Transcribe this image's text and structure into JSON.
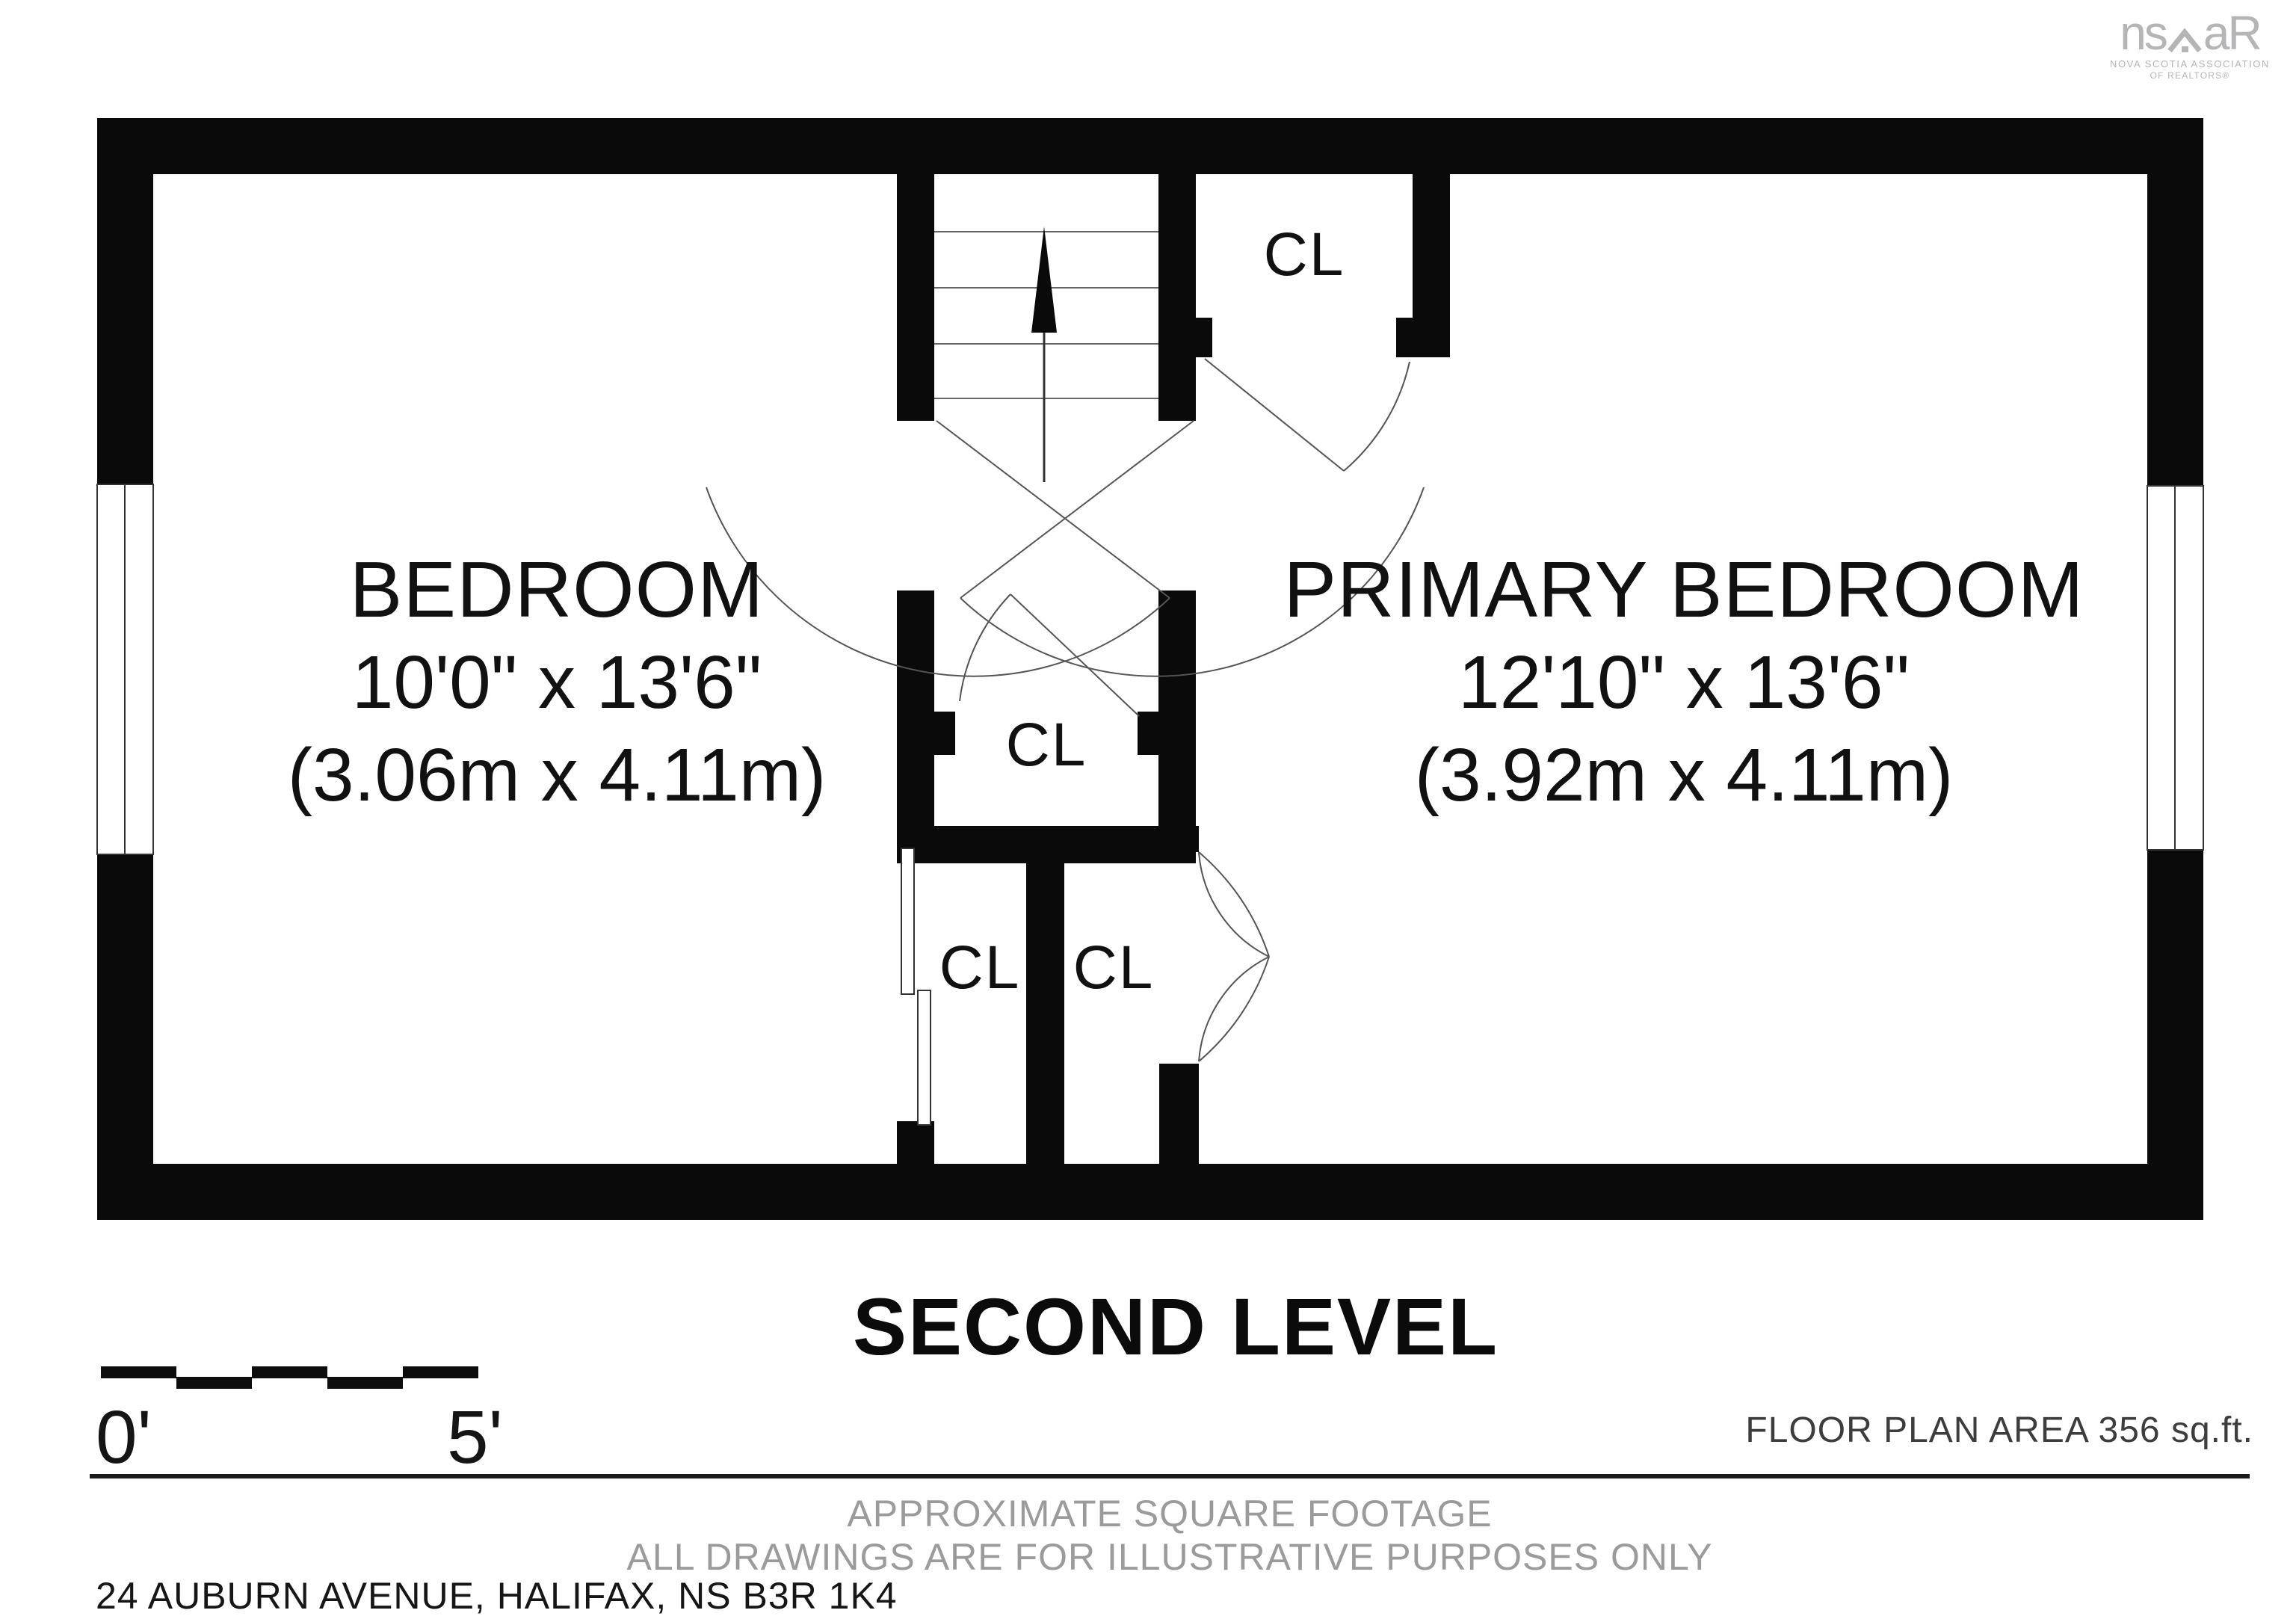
{
  "brand": {
    "logo_text_left": "ns",
    "logo_text_right": "aR",
    "tagline_line1": "NOVA SCOTIA ASSOCIATION",
    "tagline_line2": "OF REALTORS®"
  },
  "plan": {
    "rooms": [
      {
        "name": "BEDROOM",
        "dims_imperial": "10'0\" x 13'6\"",
        "dims_metric": "(3.06m x 4.11m)"
      },
      {
        "name": "PRIMARY BEDROOM",
        "dims_imperial": "12'10\" x 13'6\"",
        "dims_metric": "(3.92m x 4.11m)"
      }
    ],
    "closets": [
      {
        "label": "CL"
      },
      {
        "label": "CL"
      },
      {
        "label": "CL"
      },
      {
        "label": "CL"
      }
    ]
  },
  "footer": {
    "level_title": "SECOND LEVEL",
    "scale_zero": "0'",
    "scale_five": "5'",
    "floor_area": "FLOOR PLAN AREA 356 sq.ft.",
    "note_line1": "APPROXIMATE SQUARE FOOTAGE",
    "note_line2": "ALL DRAWINGS ARE FOR ILLUSTRATIVE PURPOSES ONLY",
    "address": "24 AUBURN AVENUE, HALIFAX, NS B3R 1K4"
  },
  "colors": {
    "wall": "#0a0a0a",
    "thin_line": "#555555",
    "logo_gray": "#b5b5b7",
    "note_gray": "#9b9b9b"
  }
}
